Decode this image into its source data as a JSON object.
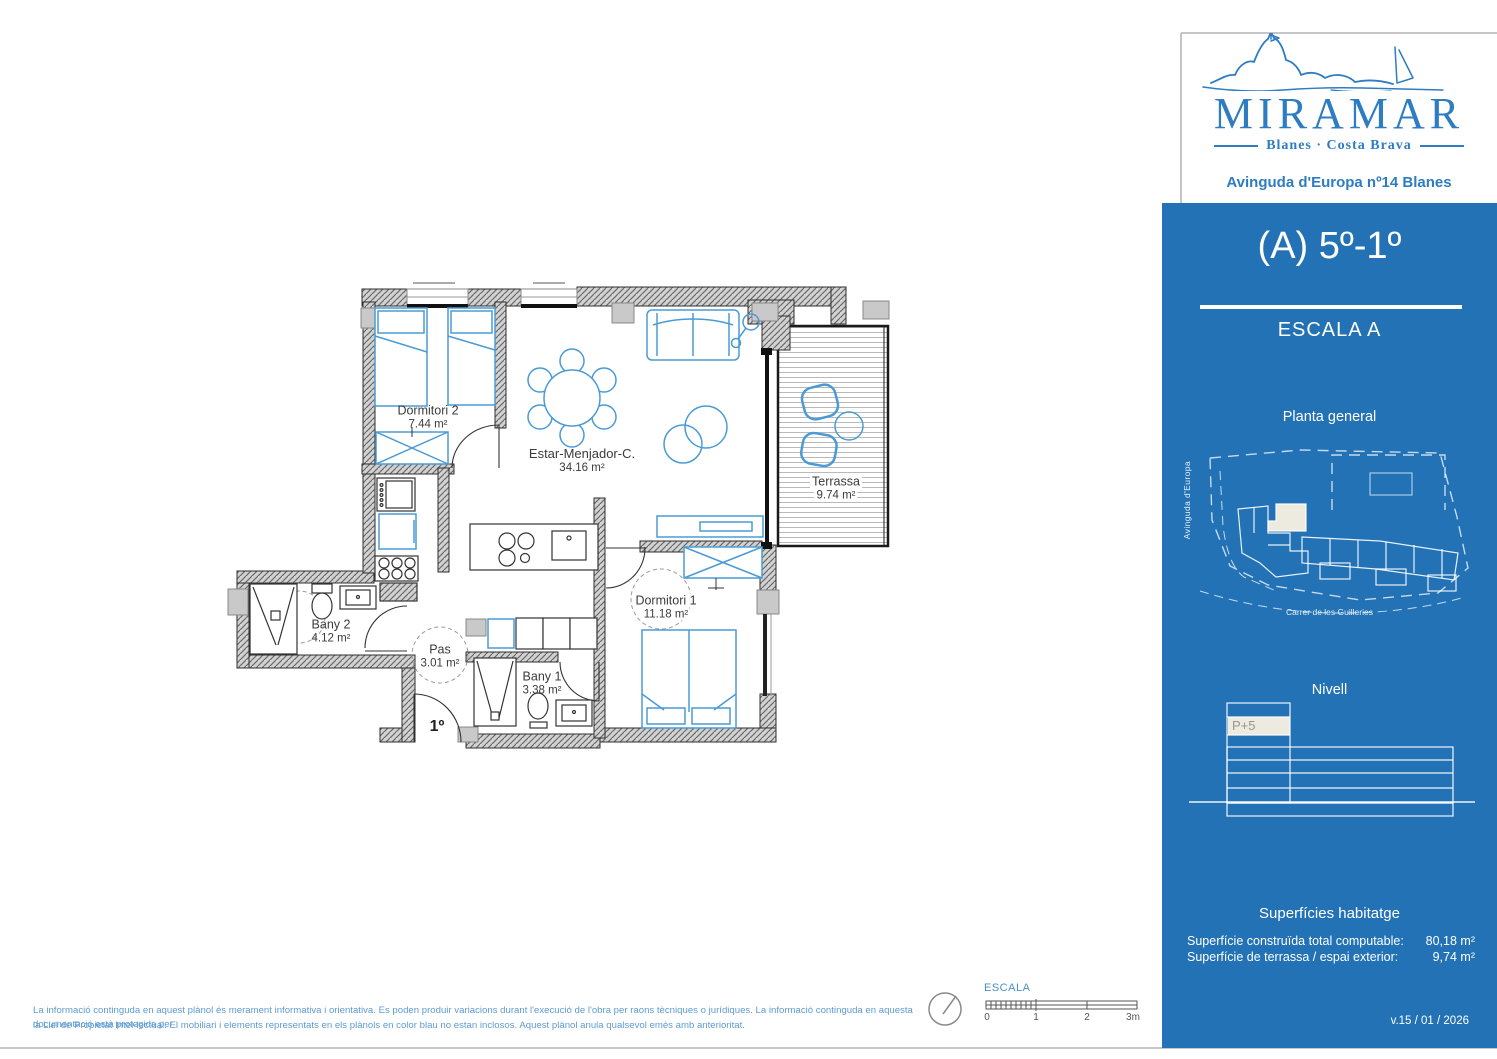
{
  "title_block": {
    "brand": "MIRAMAR",
    "tagline": "Blanes · Costa Brava",
    "address": "Avinguda d'Europa nº14 Blanes"
  },
  "sidebar": {
    "unit_title": "(A) 5º-1º",
    "stair_label": "ESCALA A",
    "site_plan_title": "Planta general",
    "street_left": "Avinguda d'Europa",
    "street_bottom": "Carrer de les Guilleries",
    "level_title": "Nivell",
    "level_highlight": "P+5",
    "surfaces_title": "Superfícies habitatge",
    "surface_rows": [
      {
        "label": "Superfície construïda total computable:",
        "value": "80,18 m²"
      },
      {
        "label": "Superfície de terrassa / espai exterior:",
        "value": "9,74 m²"
      }
    ],
    "version": "v.15 / 01 / 2026"
  },
  "floor_plan": {
    "entrance_label": "1º",
    "rooms": [
      {
        "name": "Dormitori 2",
        "area": "7.44 m²"
      },
      {
        "name": "Estar-Menjador-C.",
        "area": "34.16 m²"
      },
      {
        "name": "Terrassa",
        "area": "9.74 m²"
      },
      {
        "name": "Dormitori 1",
        "area": "11.18 m²"
      },
      {
        "name": "Bany 2",
        "area": "4.12 m²"
      },
      {
        "name": "Pas",
        "area": "3.01 m²"
      },
      {
        "name": "Bany 1",
        "area": "3.38 m²"
      }
    ]
  },
  "scale_bar": {
    "label": "ESCALA",
    "ticks": [
      "0",
      "1",
      "2",
      "3m"
    ]
  },
  "footer": {
    "line1": "La informació continguda en aquest plànol és merament informativa i orientativa. Es poden produir variacions durant l'execució de l'obra per raons tècniques o jurídiques. La informació continguda en aquesta documentació està protegida per",
    "line2": "la Llei de Propietat Intel·lectual. El mobiliari i elements representats en els plànols en color blau no estan inclosos. Aquest plànol anula qualsevol emès amb anterioritat."
  },
  "colors": {
    "sidebar_blue": "#2272b5",
    "logo_blue": "#2e7cc1",
    "furniture_blue": "#4a9bd5",
    "disclaimer_blue": "#5e9bd3",
    "wall_gray": "#6b6b6b",
    "highlight_cream": "#edebe0"
  }
}
